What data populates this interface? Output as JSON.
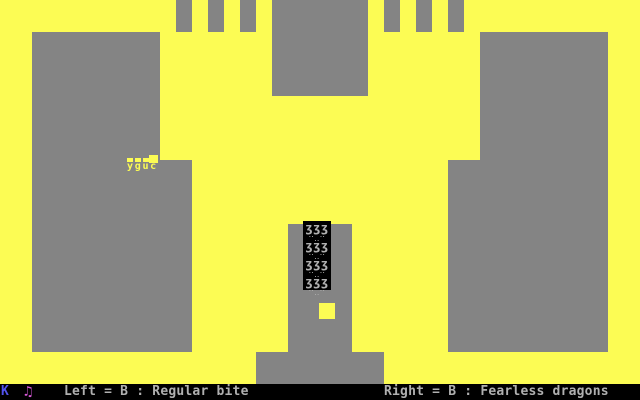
{
  "palette": {
    "yellow": "#fcfc54",
    "gray": "#848484",
    "lightgray": "#b0b0b0",
    "blue": "#5353ee",
    "magenta": "#d95ad9",
    "black": "#000000"
  },
  "status_bar": {
    "key_indicator": "K",
    "music_icon": "♫",
    "left_hint": "Left = B : Regular bite",
    "right_hint": "Right = B : Fearless dragons"
  },
  "player_dragon": {
    "legs_glyphs": "yguc"
  },
  "cage": {
    "dragon_glyphs": "ʒʒʒ",
    "dragon_feet": "‥ ‥ ‥",
    "row_count": 4
  },
  "map": {
    "playfield": {
      "x": 0,
      "y": 0,
      "w": 640,
      "h": 384
    },
    "blocks": [
      {
        "name": "battlement-left-1",
        "x": 176,
        "y": 0,
        "w": 16,
        "h": 32
      },
      {
        "name": "battlement-left-2",
        "x": 208,
        "y": 0,
        "w": 16,
        "h": 32
      },
      {
        "name": "battlement-left-3",
        "x": 240,
        "y": 0,
        "w": 16,
        "h": 32
      },
      {
        "name": "battlement-right-1",
        "x": 384,
        "y": 0,
        "w": 16,
        "h": 32
      },
      {
        "name": "battlement-right-2",
        "x": 416,
        "y": 0,
        "w": 16,
        "h": 32
      },
      {
        "name": "battlement-right-3",
        "x": 448,
        "y": 0,
        "w": 16,
        "h": 32
      },
      {
        "name": "top-center-block",
        "x": 272,
        "y": 0,
        "w": 96,
        "h": 96
      },
      {
        "name": "left-wall",
        "x": 32,
        "y": 32,
        "w": 128,
        "h": 320
      },
      {
        "name": "left-wall-extension",
        "x": 160,
        "y": 160,
        "w": 32,
        "h": 192
      },
      {
        "name": "right-wall",
        "x": 480,
        "y": 32,
        "w": 128,
        "h": 320
      },
      {
        "name": "right-wall-extension",
        "x": 448,
        "y": 160,
        "w": 32,
        "h": 192
      },
      {
        "name": "center-column",
        "x": 288,
        "y": 224,
        "w": 64,
        "h": 128
      },
      {
        "name": "center-base",
        "x": 256,
        "y": 352,
        "w": 128,
        "h": 32
      }
    ],
    "cage_box": {
      "x": 303,
      "y": 221,
      "w": 28,
      "h": 69
    },
    "exit_hole": {
      "x": 319,
      "y": 303,
      "w": 16,
      "h": 16
    },
    "player": {
      "x": 127,
      "y": 155
    }
  }
}
